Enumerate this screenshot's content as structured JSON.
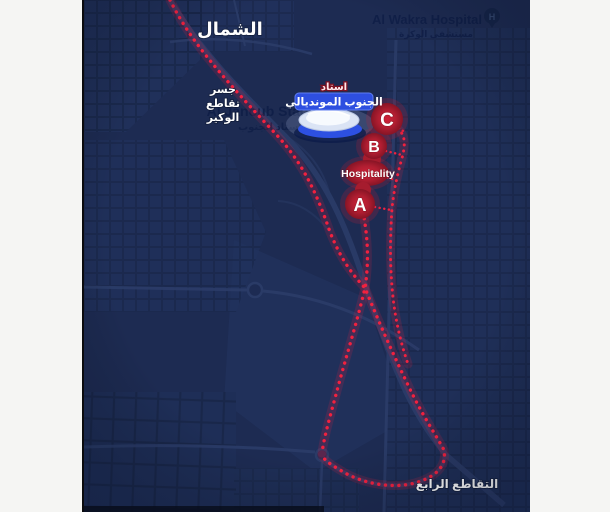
{
  "map": {
    "background_color": "#1d2b52",
    "margin_color": "#f5f5f3",
    "route_color": "#f2213f",
    "zone_color": "#b71f33",
    "labels": {
      "north_ar": "الشمال",
      "hospital_en": "Al Wakra Hospital",
      "hospital_ar": "مستشفى الوكرة",
      "hospital_marker": "H",
      "bridge_line1": "جسر",
      "bridge_line2": "تقاطع",
      "bridge_line3": "الوكير",
      "stadium_en": "Al Janoub Stadium",
      "stadium_ar": "إستاد الجنوب",
      "intersection_ar": "التقاطع الرابع"
    },
    "stadium_callout": {
      "top_ar": "استاد",
      "badge_ar": "الجنوب المونديالي",
      "badge_color": "#2e4fe0"
    },
    "zones": [
      {
        "id": "C",
        "label": "C"
      },
      {
        "id": "B",
        "label": "B"
      },
      {
        "id": "hospitality",
        "label": "Hospitality"
      },
      {
        "id": "A",
        "label": "A"
      }
    ]
  }
}
